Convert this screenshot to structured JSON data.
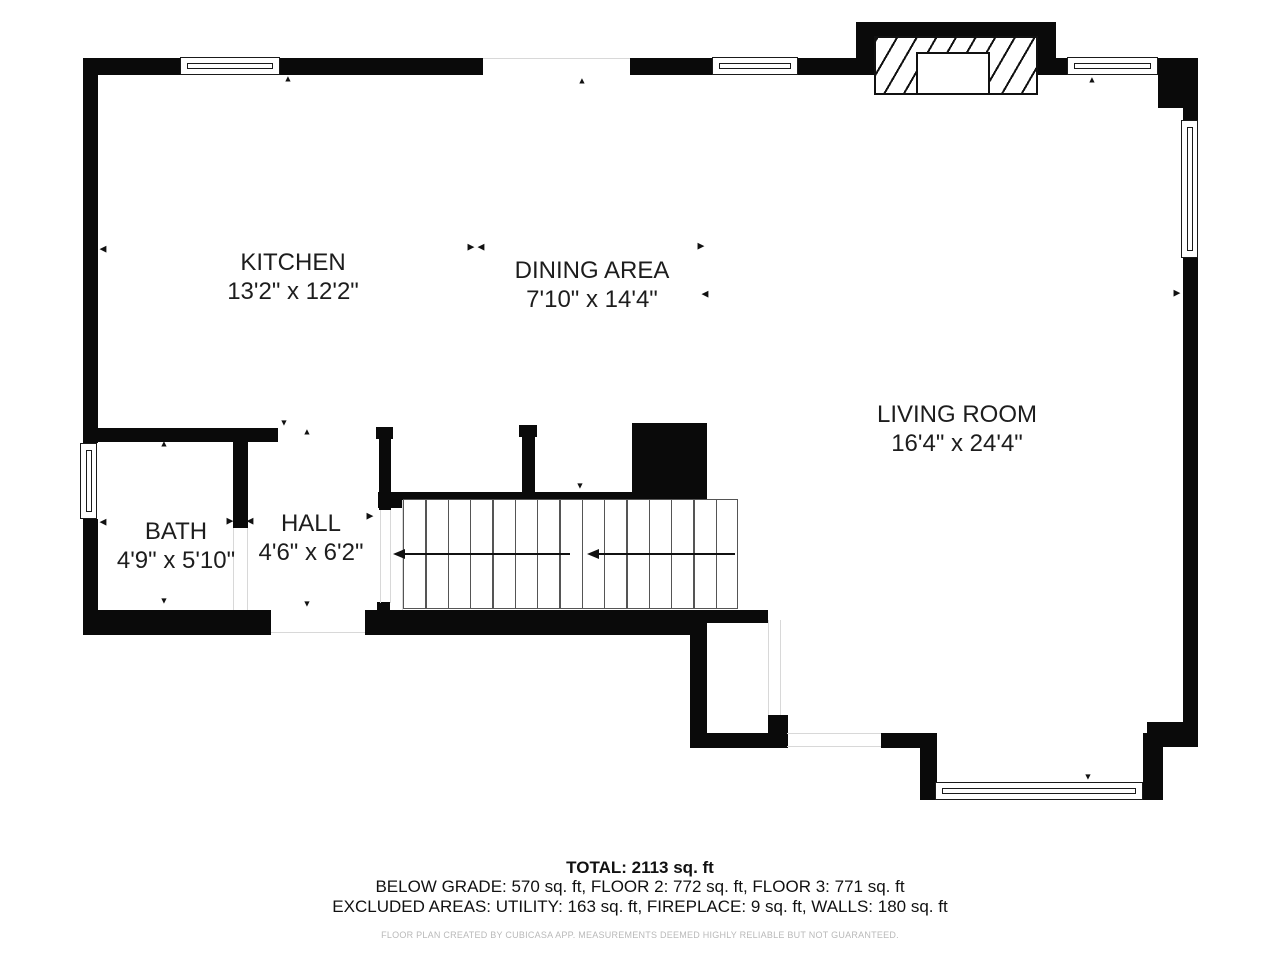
{
  "colors": {
    "wall": "#0a0a0a",
    "text": "#1d1d1d",
    "muted": "#b9b9b9",
    "background": "#ffffff"
  },
  "rooms": [
    {
      "id": "kitchen",
      "name": "KITCHEN",
      "dims": "13'2\" x 12'2\""
    },
    {
      "id": "dining",
      "name": "DINING AREA",
      "dims": "7'10\" x 14'4\""
    },
    {
      "id": "living",
      "name": "LIVING ROOM",
      "dims": "16'4\" x 24'4\""
    },
    {
      "id": "bath",
      "name": "BATH",
      "dims": "4'9\" x 5'10\""
    },
    {
      "id": "hall",
      "name": "HALL",
      "dims": "4'6\" x 6'2\""
    }
  ],
  "footer": {
    "total": "TOTAL: 2113 sq. ft",
    "line2": "BELOW GRADE: 570 sq. ft, FLOOR 2: 772 sq. ft, FLOOR 3: 771 sq. ft",
    "line3": "EXCLUDED AREAS: UTILITY: 163 sq. ft, FIREPLACE: 9 sq. ft, WALLS: 180 sq. ft",
    "disclaimer": "FLOOR PLAN CREATED BY CUBICASA APP. MEASUREMENTS DEEMED HIGHLY RELIABLE BUT NOT GUARANTEED."
  },
  "icons": {
    "up": "▲",
    "down": "▼",
    "left": "◀",
    "right": "▶"
  }
}
